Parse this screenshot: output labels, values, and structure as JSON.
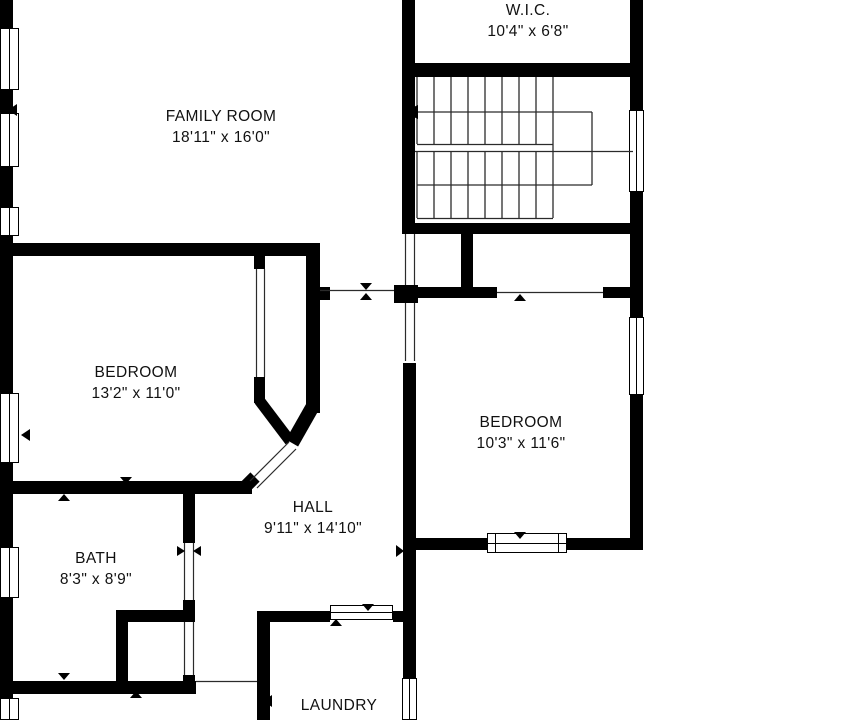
{
  "rooms": [
    {
      "id": "wic",
      "name": "W.I.C.",
      "dims": "10'4\" x 6'8\""
    },
    {
      "id": "family_room",
      "name": "FAMILY ROOM",
      "dims": "18'11\" x 16'0\""
    },
    {
      "id": "bedroom_left",
      "name": "BEDROOM",
      "dims": "13'2\" x 11'0\""
    },
    {
      "id": "bedroom_right",
      "name": "BEDROOM",
      "dims": "10'3\" x 11'6\""
    },
    {
      "id": "hall",
      "name": "HALL",
      "dims": "9'11\" x 14'10\""
    },
    {
      "id": "bath",
      "name": "BATH",
      "dims": "8'3\" x 8'9\""
    },
    {
      "id": "laundry",
      "name": "LAUNDRY",
      "dims": ""
    }
  ],
  "colors": {
    "wall": "#000000",
    "background": "#ffffff",
    "thin_line": "#2b2b2b",
    "text": "#111111"
  }
}
